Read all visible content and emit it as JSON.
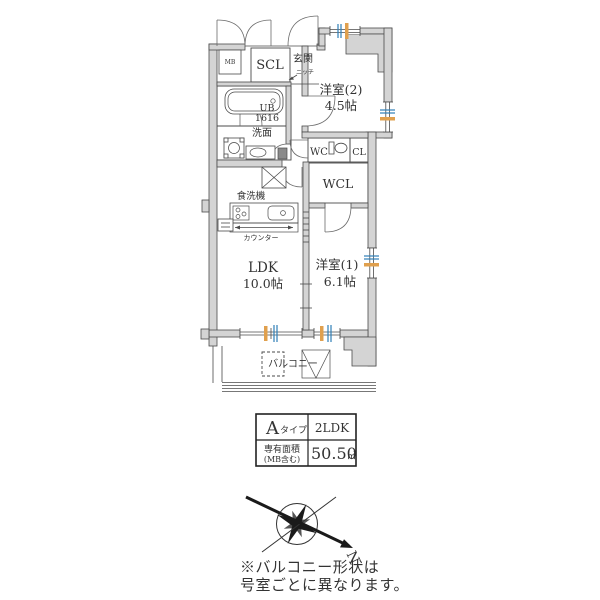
{
  "floor_plan": {
    "labels": {
      "mb": "MB",
      "scl": "SCL",
      "genkan": "玄関",
      "niche": "ニッチ",
      "ub_line1": "UB",
      "ub_line2": "1616",
      "senmen": "洗面",
      "room2_name": "洋室(2)",
      "room2_size": "4.5帖",
      "wc": "WC",
      "cl": "CL",
      "wcl": "WCL",
      "dishwasher": "食洗機",
      "counter": "カウンター",
      "ldk_name": "LDK",
      "ldk_size": "10.0帖",
      "room1_name": "洋室(1)",
      "room1_size": "6.1帖",
      "balcony": "バルコニー"
    },
    "colors": {
      "wall": "#d4d4d4",
      "wet_area_pink": "#f3dade",
      "storage_blue": "#cadfeb",
      "window_blue": "#2e7fb8",
      "window_orange": "#e0a04e"
    }
  },
  "info_table": {
    "type_letter": "A",
    "type_suffix": "タイプ",
    "layout_type": "2LDK",
    "area_label_line1": "専有面積",
    "area_label_line2": "(MB含む)",
    "area_value": "50.50",
    "area_unit": "㎡"
  },
  "compass": {
    "north_label": "N"
  },
  "note": {
    "line1": "※バルコニー形状は",
    "line2": "号室ごとに異なります。"
  }
}
